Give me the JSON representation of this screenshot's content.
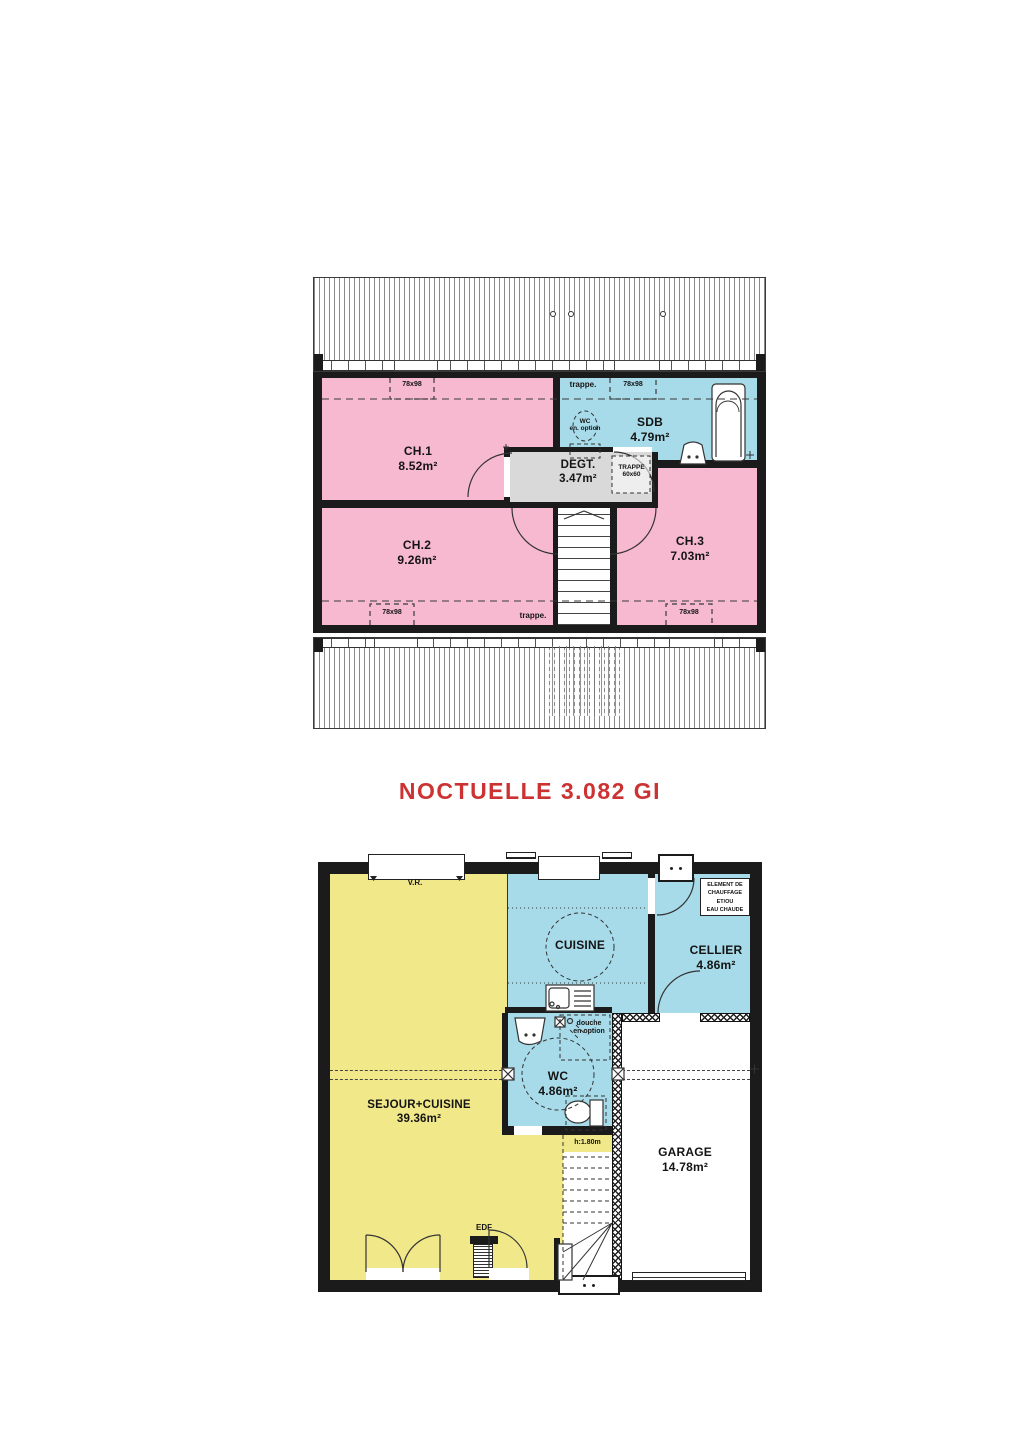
{
  "title": "NOCTUELLE 3.082 GI",
  "colors": {
    "bedroom_pink": "#f6b9d0",
    "wet_room_blue": "#a7dbe9",
    "living_yellow": "#f1e88a",
    "landing_gray": "#d9d9d9",
    "wall_black": "#1b1b1b",
    "title_red": "#cd3233"
  },
  "upper": {
    "rooms": {
      "ch1": {
        "name": "CH.1",
        "area": "8.52m²"
      },
      "ch2": {
        "name": "CH.2",
        "area": "9.26m²"
      },
      "ch3": {
        "name": "CH.3",
        "area": "7.03m²"
      },
      "sdb": {
        "name": "SDB",
        "area": "4.79m²"
      },
      "degt": {
        "name": "DEGT.",
        "area": "3.47m²"
      }
    },
    "labels": {
      "trappe_top": "trappe.",
      "trappe_bottom": "trappe.",
      "window_tl": "78x98",
      "window_tr": "78x98",
      "window_bl": "78x98",
      "window_br": "78x98",
      "wc_option_line1": "WC",
      "wc_option_line2": "en. option",
      "trappe_hatch_line1": "TRAPPE",
      "trappe_hatch_line2": "60x60"
    }
  },
  "ground": {
    "rooms": {
      "sejour": {
        "name": "SEJOUR+CUISINE",
        "area": "39.36m²"
      },
      "cuisine": {
        "name": "CUISINE"
      },
      "cellier": {
        "name": "CELLIER",
        "area": "4.86m²"
      },
      "wc": {
        "name": "WC",
        "area": "4.86m²"
      },
      "garage": {
        "name": "GARAGE",
        "area": "14.78m²"
      }
    },
    "labels": {
      "shutter": "V.R.",
      "edf": "EDF",
      "stair_height": "h:1.80m",
      "douche_line1": "douche",
      "douche_line2": "en option",
      "heater_line1": "ELEMENT DE",
      "heater_line2": "CHAUFFAGE",
      "heater_line3": "ET/OU",
      "heater_line4": "EAU CHAUDE"
    }
  }
}
